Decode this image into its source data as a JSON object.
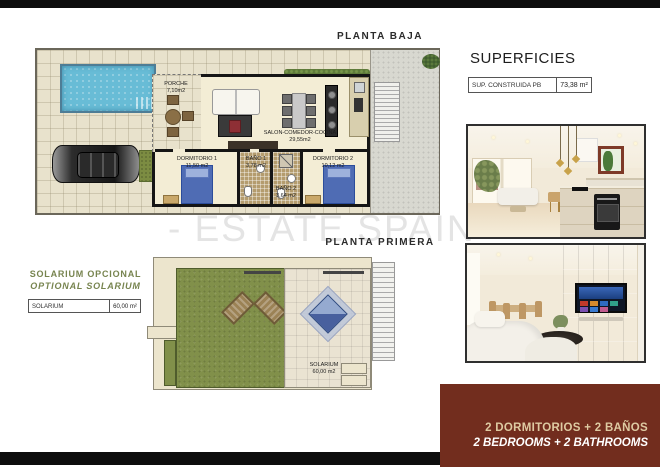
{
  "watermark": {
    "text": "- ESTATE SPAIN"
  },
  "plans": {
    "ground": {
      "title": "PLANTA BAJA",
      "rooms": {
        "porche": {
          "name": "PORCHE",
          "area": "7,10m2"
        },
        "salon": {
          "name": "SALON-COMEDOR-COCINA",
          "area": "29,55m2"
        },
        "dormitorio1": {
          "name": "DORMITORIO 1",
          "area": "11,50 m2"
        },
        "bano1": {
          "name": "BAÑO 1",
          "area": "3,78 m2"
        },
        "bano2": {
          "name": "BAÑO 2",
          "area": "3,64 m2"
        },
        "dormitorio2": {
          "name": "DORMITORIO 2",
          "area": "10,12 m2"
        }
      }
    },
    "first": {
      "title": "PLANTA PRIMERA",
      "rooms": {
        "solarium": {
          "name": "SOLARIUM",
          "area": "60,00 m2"
        }
      }
    }
  },
  "superficies": {
    "title": "SUPERFICIES",
    "rows": [
      {
        "label": "SUP. CONSTRUIDA PB",
        "value": "73,38 m²"
      }
    ]
  },
  "solarium_note": {
    "title_es": "SOLARIUM OPCIONAL",
    "title_en": "OPTIONAL SOLARIUM",
    "table": {
      "label": "SOLARIUM",
      "value": "60,00 m²"
    }
  },
  "footer": {
    "line_es": "2 DORMITORIOS + 2 BAÑOS",
    "line_en": "2 BEDROOMS + 2 BATHROOMS"
  },
  "colors": {
    "accent_red": "#722d1e",
    "green_heading": "#77844f",
    "cream_text": "#decaa2"
  }
}
